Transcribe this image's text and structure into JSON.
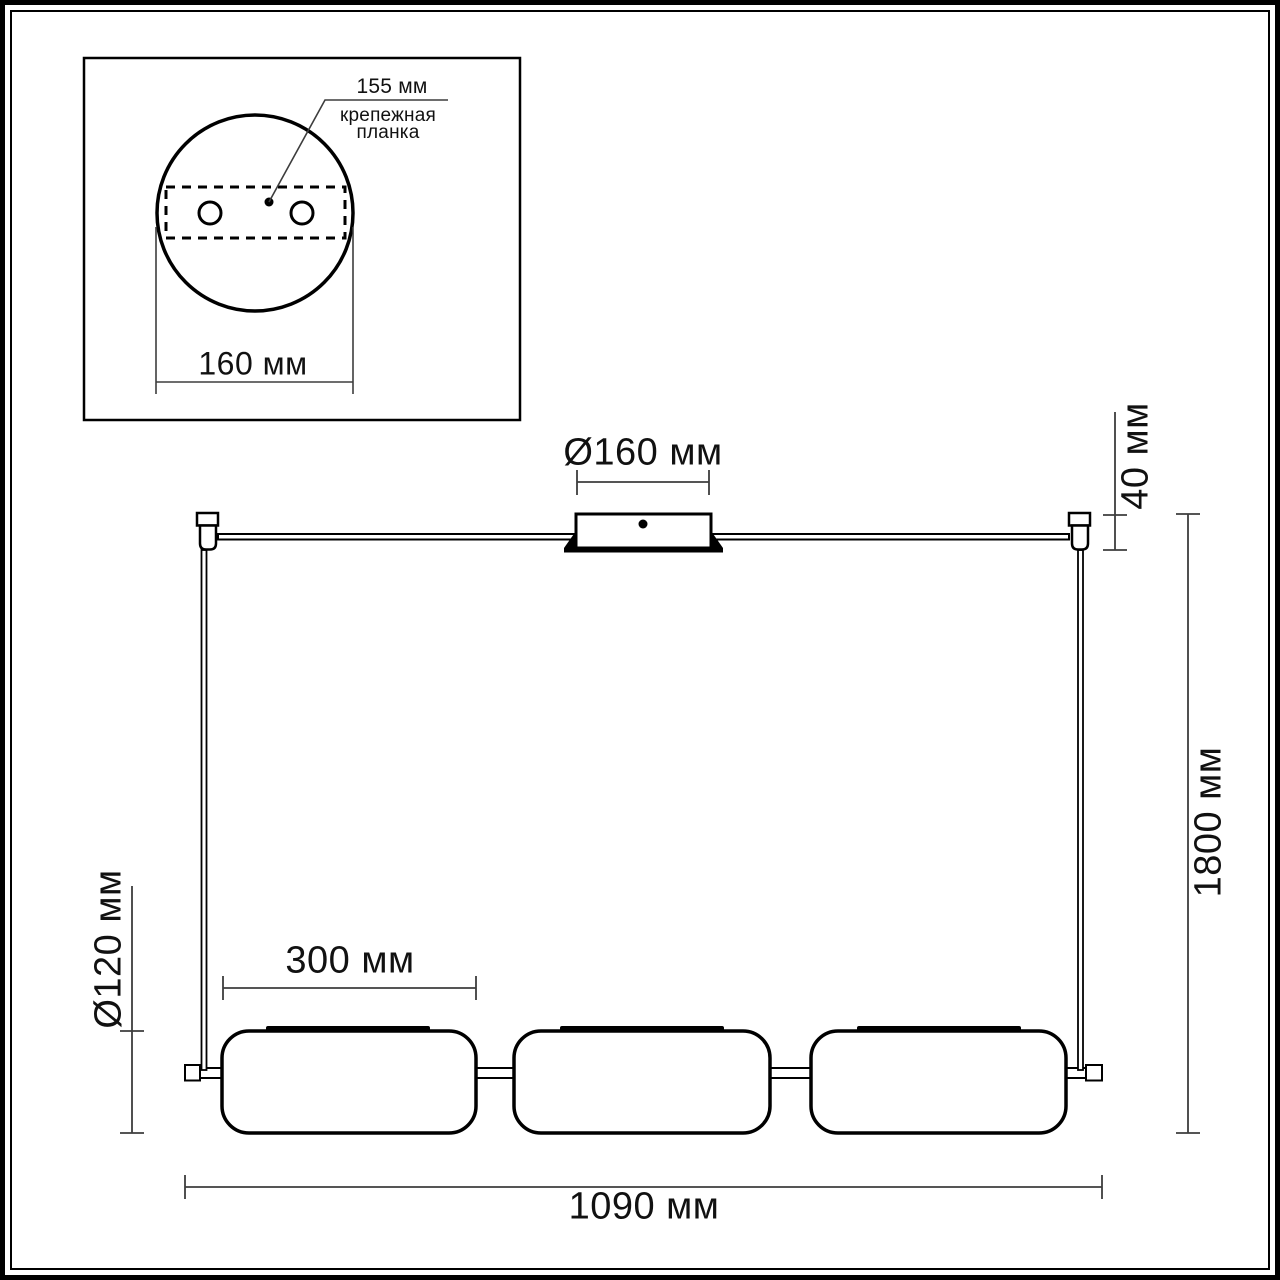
{
  "inset": {
    "plate_length_label": "155 мм",
    "plate_name_line1": "крепежная",
    "plate_name_line2": "планка",
    "base_diameter_label": "160 мм"
  },
  "dimensions": {
    "canopy_diameter": "Ø160 мм",
    "canopy_height": "40 мм",
    "max_height": "1800 мм",
    "shade_diameter": "Ø120 мм",
    "shade_width": "300 мм",
    "total_width": "1090 мм"
  },
  "colors": {
    "ink": "#000000",
    "dimension_line": "#3d3d3d",
    "background": "#ffffff"
  }
}
